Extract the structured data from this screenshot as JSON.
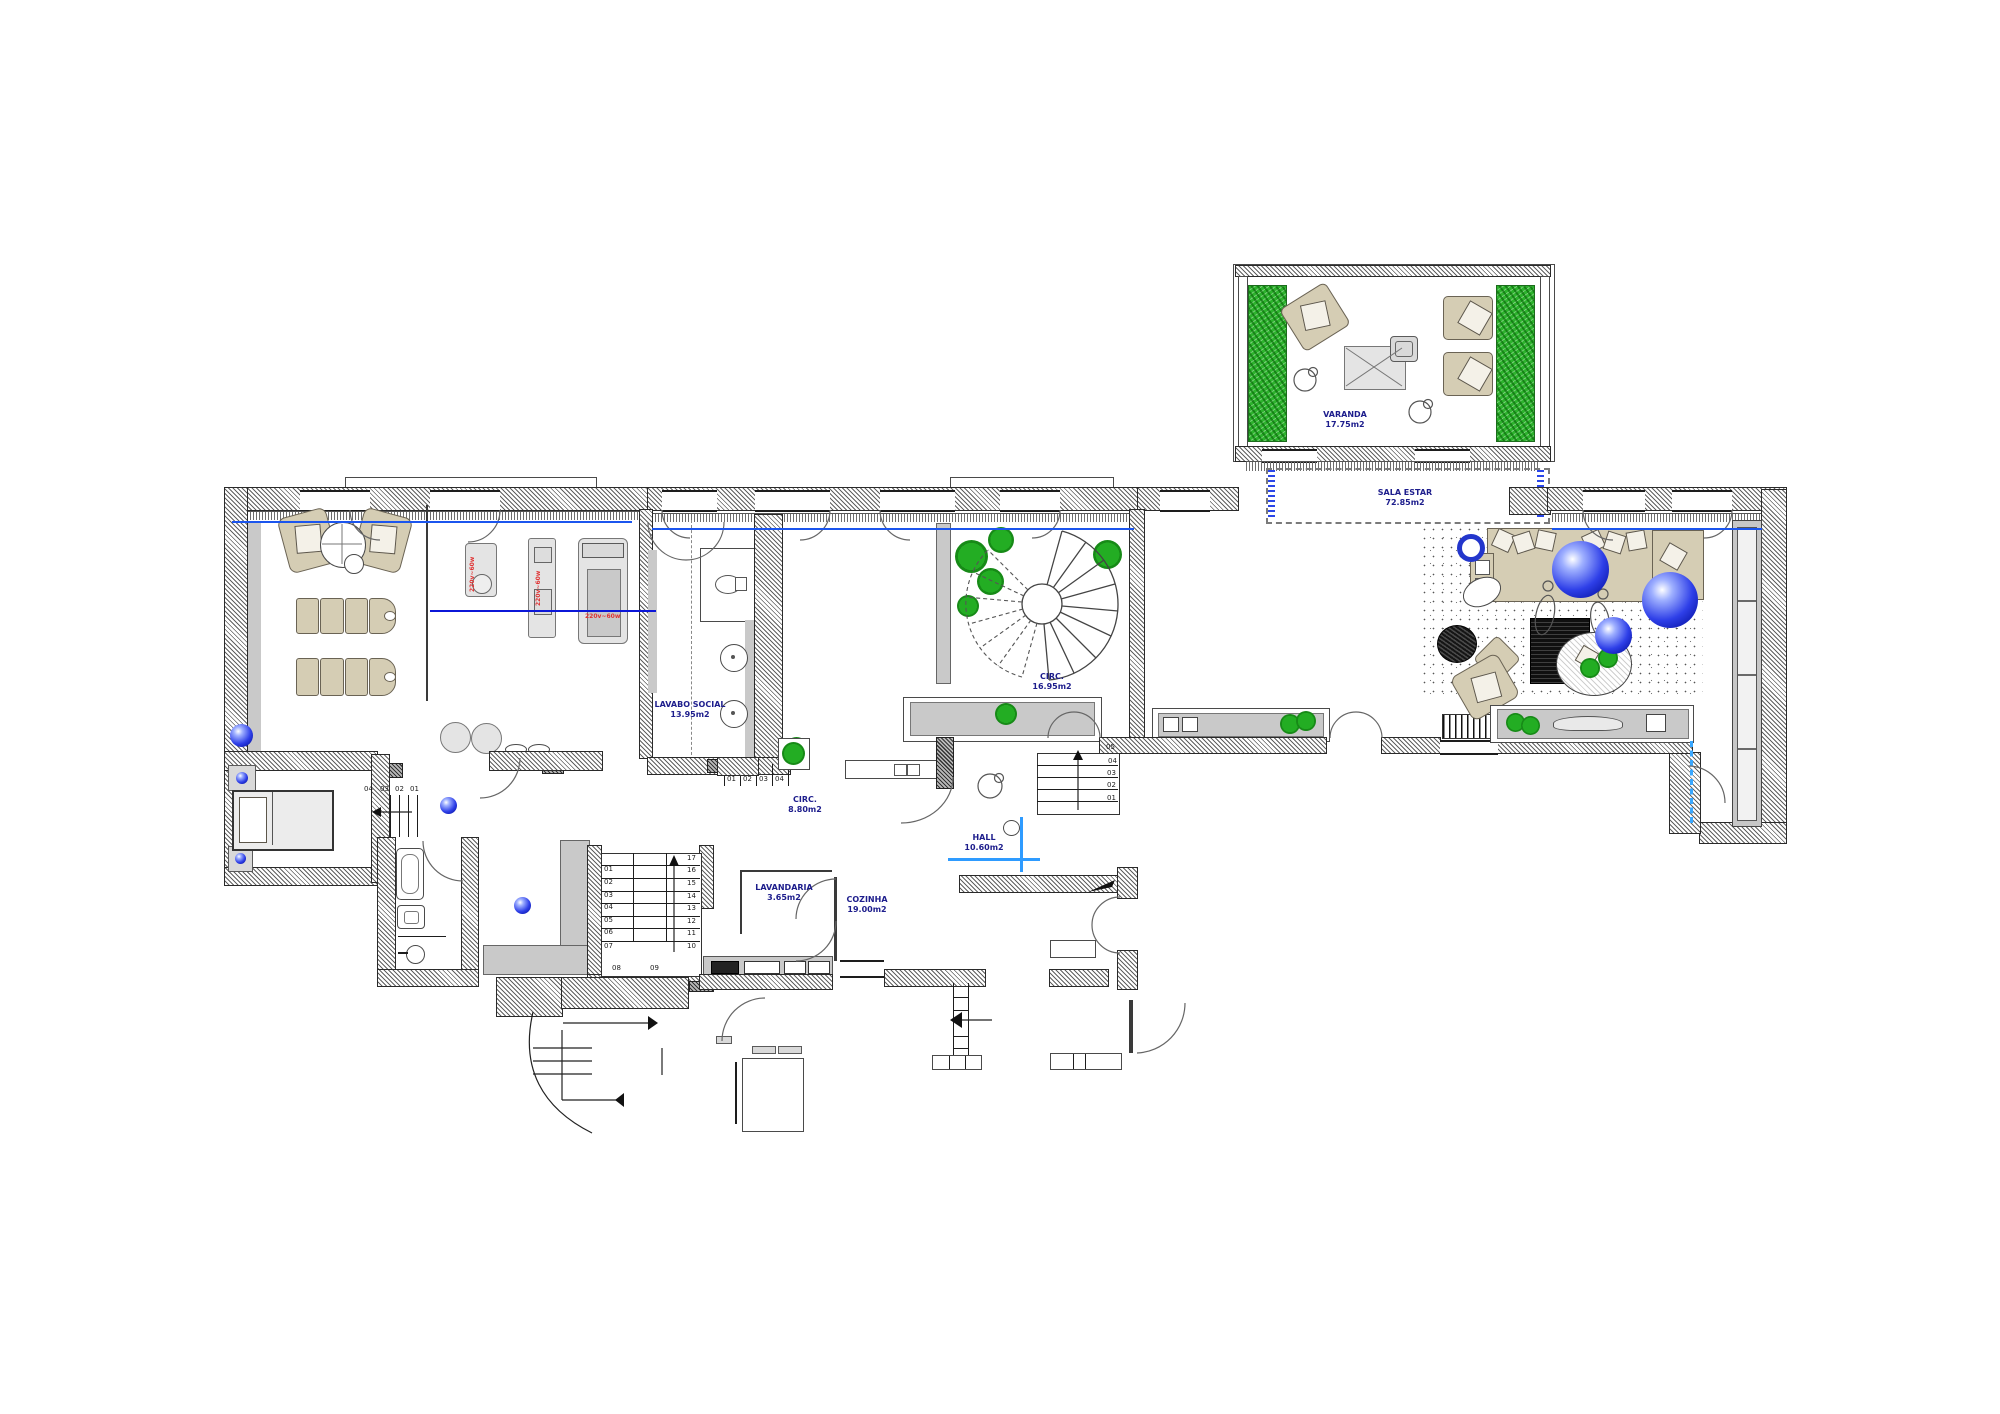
{
  "rooms": {
    "varanda": {
      "name": "VARANDA",
      "area": "17.75m2"
    },
    "sala_estar": {
      "name": "SALA ESTAR",
      "area": "72.85m2"
    },
    "lavabo_social": {
      "name": "LAVABO SOCIAL",
      "area": "13.95m2"
    },
    "circ_main": {
      "name": "CIRC.",
      "area": "16.95m2"
    },
    "circ_small": {
      "name": "CIRC.",
      "area": "8.80m2"
    },
    "hall": {
      "name": "HALL",
      "area": "10.60m2"
    },
    "lavandaria": {
      "name": "LAVANDARIA",
      "area": "3.65m2"
    },
    "cozinha": {
      "name": "COZINHA",
      "area": "19.00m2"
    }
  },
  "stairs": {
    "main": {
      "left": [
        "01",
        "02",
        "03",
        "04",
        "05",
        "06",
        "07"
      ],
      "right": [
        "17",
        "16",
        "15",
        "14",
        "13",
        "12",
        "11",
        "10"
      ],
      "bottom": [
        "08",
        "09"
      ]
    },
    "hall_steps": [
      "05",
      "04",
      "03",
      "02",
      "01"
    ],
    "entry_steps": [
      "01",
      "02",
      "03",
      "04"
    ],
    "bed_steps": [
      "04",
      "03",
      "02",
      "01"
    ]
  },
  "equipment": {
    "gym_power_labels": [
      "220v~60w",
      "220v~60w",
      "220v~60w"
    ]
  },
  "colors": {
    "label_blue": "#1d1d8c",
    "accent_blue": "#1b55ee",
    "bright_blue": "#2e9bff",
    "plant_green": "#23ad23",
    "sphere_blue": "#2e3fe8",
    "equipment_red": "#e03434",
    "furniture_tan": "#d5cdb4"
  }
}
